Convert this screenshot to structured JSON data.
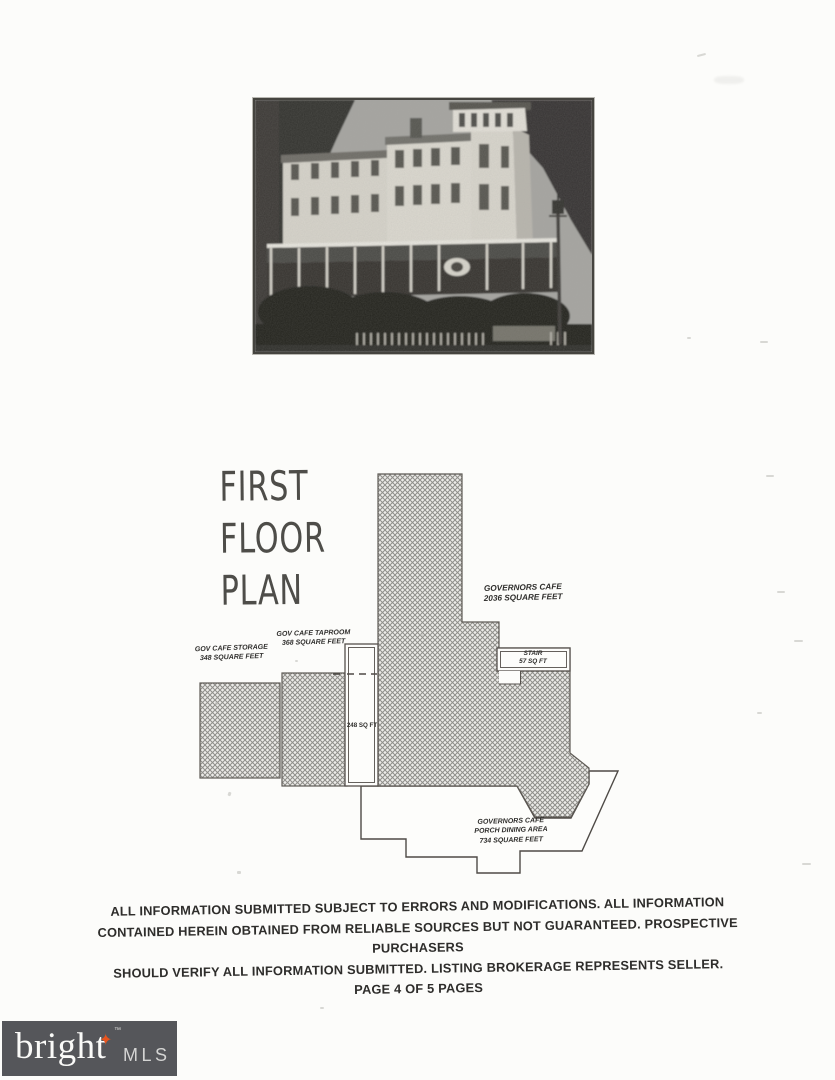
{
  "title": {
    "lines": [
      "FIRST",
      "FLOOR",
      "PLAN"
    ]
  },
  "photo": {
    "description": "three-story building with corner tower, wrap porch, shrubs, picket fence and lamppost"
  },
  "plan": {
    "rooms": {
      "governors_cafe": {
        "name": "GOVERNORS CAFE",
        "area": "2036 SQUARE FEET"
      },
      "taproom": {
        "name": "GOV CAFE TAPROOM",
        "area": "368 SQUARE FEET"
      },
      "storage": {
        "name": "GOV CAFE STORAGE",
        "area": "348 SQUARE FEET"
      },
      "stair": {
        "name": "STAIR",
        "area": "57 SQ FT"
      },
      "corridor": {
        "area": "248 SQ FT"
      },
      "porch": {
        "name": "GOVERNORS CAFE",
        "name2": "PORCH DINING AREA",
        "area": "734 SQUARE FEET"
      }
    }
  },
  "disclaimer": {
    "lines": [
      "ALL INFORMATION SUBMITTED SUBJECT TO ERRORS AND MODIFICATIONS. ALL INFORMATION",
      "CONTAINED HEREIN OBTAINED FROM RELIABLE SOURCES BUT NOT GUARANTEED. PROSPECTIVE PURCHASERS",
      "SHOULD VERIFY ALL INFORMATION SUBMITTED. LISTING BROKERAGE REPRESENTS SELLER.",
      "PAGE 4 OF 5 PAGES"
    ]
  },
  "footer": {
    "brand": "bright",
    "brand_suffix": "MLS",
    "trademark": "™",
    "star_glyph": "✦",
    "bar_color": "#55565a",
    "star_color": "#e8541e"
  }
}
